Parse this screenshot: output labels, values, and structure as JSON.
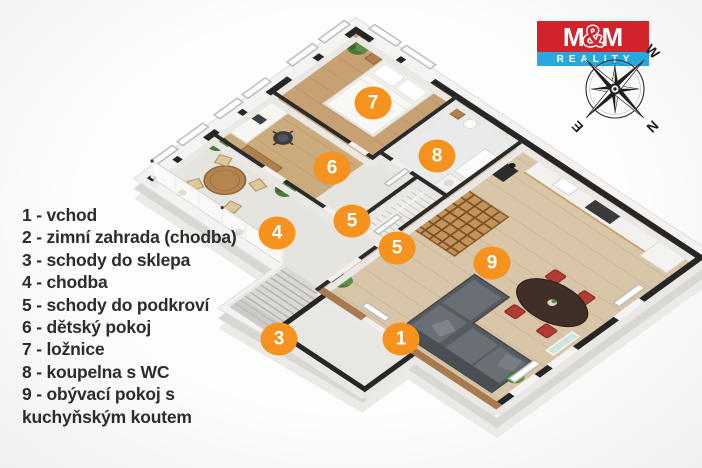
{
  "legend": {
    "items": [
      "1 - vchod",
      "2 - zimní zahrada (chodba)",
      "3 - schody do sklepa",
      "4 - chodba",
      "5 - schody do podkroví",
      "6 - dětský pokoj",
      "7 - ložnice",
      "8 - koupelna s WC",
      "9 - obývací pokoj s kuchyňským koutem"
    ]
  },
  "badges": {
    "items": [
      "1",
      "3",
      "4",
      "5",
      "5",
      "6",
      "7",
      "8",
      "9"
    ]
  },
  "logo": {
    "m_left": "M",
    "ampersand": "&",
    "m_right": "M",
    "subtitle": "REALITY"
  },
  "compass": {
    "w": "W",
    "n": "N",
    "e": "E"
  },
  "colors": {
    "badge": "#f6921e",
    "brand_red": "#d2232a",
    "brand_blue": "#29a8e0",
    "wall": "#262626",
    "wood_wall": "#a87a4f"
  }
}
